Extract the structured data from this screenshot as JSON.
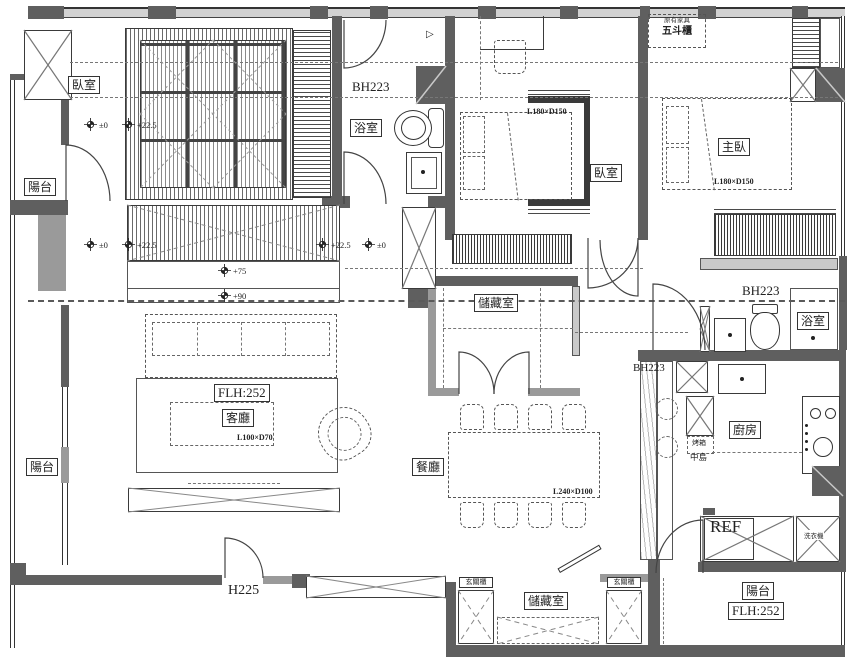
{
  "title": "apartment-floor-plan",
  "colors": {
    "wall": "#5f5f5f",
    "wall_mid": "#9a9a9a",
    "beam": "#d2d2d2",
    "line": "#3a3a3a",
    "background": "#ffffff"
  },
  "rooms": {
    "bedroom_top_left": "臥室",
    "balcony_upper_left": "陽台",
    "balcony_lower_left": "陽台",
    "bathroom_left": "浴室",
    "bedroom_center": "臥室",
    "master_bedroom": "主臥",
    "storage_center": "儲藏室",
    "bathroom_right": "浴室",
    "kitchen": "廚房",
    "living_room": "客廳",
    "dining_room": "餐廳",
    "storage_bottom": "儲藏室",
    "balcony_bottom_right": "陽台"
  },
  "annotations": {
    "beam_bath_left": "BH223",
    "beam_master": "BH223",
    "beam_kitchen": "BH223",
    "floor_height_living": "FLH:252",
    "floor_height_balcony": "FLH:252",
    "entry_door_height": "H225",
    "bed_center_dim": "L180×D150",
    "bed_master_dim": "L180×D150",
    "sofa_dim": "L100×D70",
    "dining_table_dim": "L240×D100",
    "existing_furniture_note": "原有家具",
    "dresser": "五斗櫃",
    "oven": "烤箱",
    "island": "中島",
    "refrigerator": "REF",
    "washer": "洗衣機",
    "entry_cabinet_left": "玄關櫃",
    "entry_cabinet_right": "玄關櫃"
  },
  "levels": {
    "row1_zero": "±0",
    "row1_225": "+22.5",
    "row2_zero_left": "±0",
    "row2_225_left": "+22.5",
    "row2_225_right": "+22.5",
    "row2_zero_right": "±0",
    "step_75": "+75",
    "step_90": "+90"
  }
}
